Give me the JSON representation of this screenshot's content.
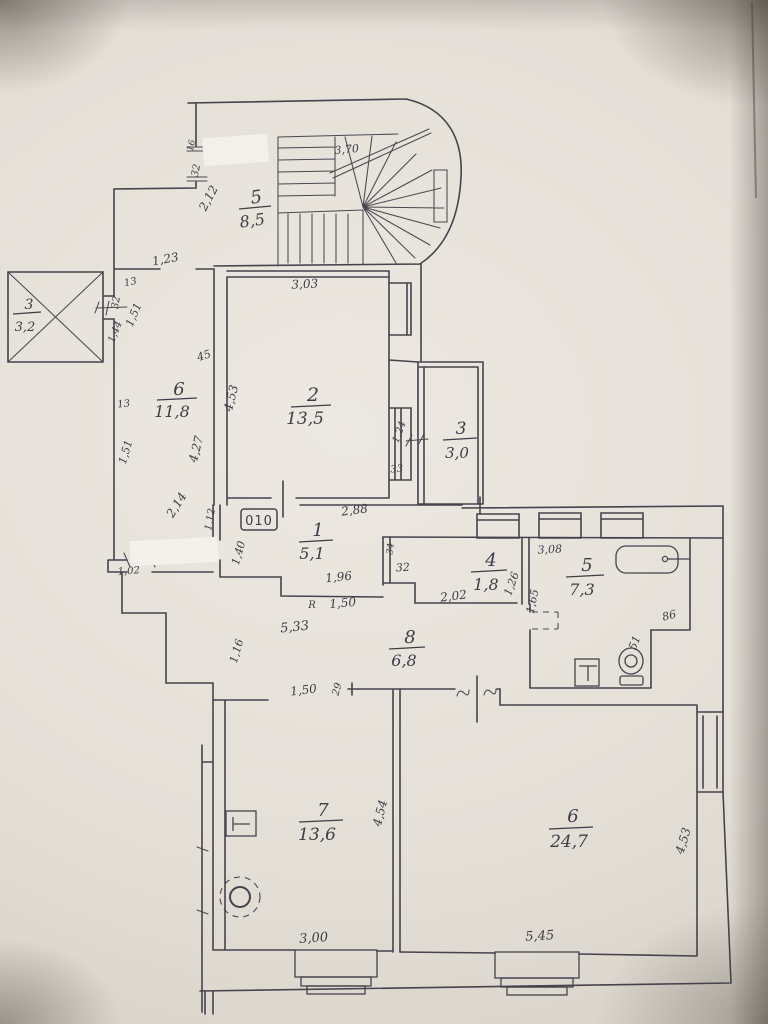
{
  "colors": {
    "paper": "#e4dfd7",
    "ink": "#45434c"
  },
  "apartment_number": "010",
  "rooms": [
    {
      "number": "5",
      "area": "8,5"
    },
    {
      "number": "3",
      "area": "3,2"
    },
    {
      "number": "6",
      "area": "11,8"
    },
    {
      "number": "2",
      "area": "13,5"
    },
    {
      "number": "3",
      "area": "3,0"
    },
    {
      "number": "1",
      "area": "5,1"
    },
    {
      "number": "4",
      "area": "1,8"
    },
    {
      "number": "5",
      "area": "7,3"
    },
    {
      "number": "8",
      "area": "6,8"
    },
    {
      "number": "7",
      "area": "13,6"
    },
    {
      "number": "6",
      "area": "24,7"
    }
  ],
  "dimensions": [
    {
      "t": "3,70"
    },
    {
      "t": "16"
    },
    {
      "t": "32"
    },
    {
      "t": "2,12"
    },
    {
      "t": "1,23"
    },
    {
      "t": "13"
    },
    {
      "t": "32"
    },
    {
      "t": "1,51"
    },
    {
      "t": "1,44"
    },
    {
      "t": "45"
    },
    {
      "t": "4,53"
    },
    {
      "t": "4,27"
    },
    {
      "t": "13"
    },
    {
      "t": "1,51"
    },
    {
      "t": "2,14"
    },
    {
      "t": "3,03"
    },
    {
      "t": "1,24"
    },
    {
      "t": "33"
    },
    {
      "t": "2,88"
    },
    {
      "t": "1,12"
    },
    {
      "t": "1,40"
    },
    {
      "t": "1,02"
    },
    {
      "t": "1,96"
    },
    {
      "t": "1,50"
    },
    {
      "t": "5,33"
    },
    {
      "t": "1,16"
    },
    {
      "t": "34"
    },
    {
      "t": "32"
    },
    {
      "t": "2,02"
    },
    {
      "t": "1,26"
    },
    {
      "t": "1,65"
    },
    {
      "t": "3,08"
    },
    {
      "t": "86"
    },
    {
      "t": "51"
    },
    {
      "t": "1,50"
    },
    {
      "t": "29"
    },
    {
      "t": "4,54"
    },
    {
      "t": "3,00"
    },
    {
      "t": "5,45"
    },
    {
      "t": "4,53"
    },
    {
      "t": "R"
    }
  ]
}
